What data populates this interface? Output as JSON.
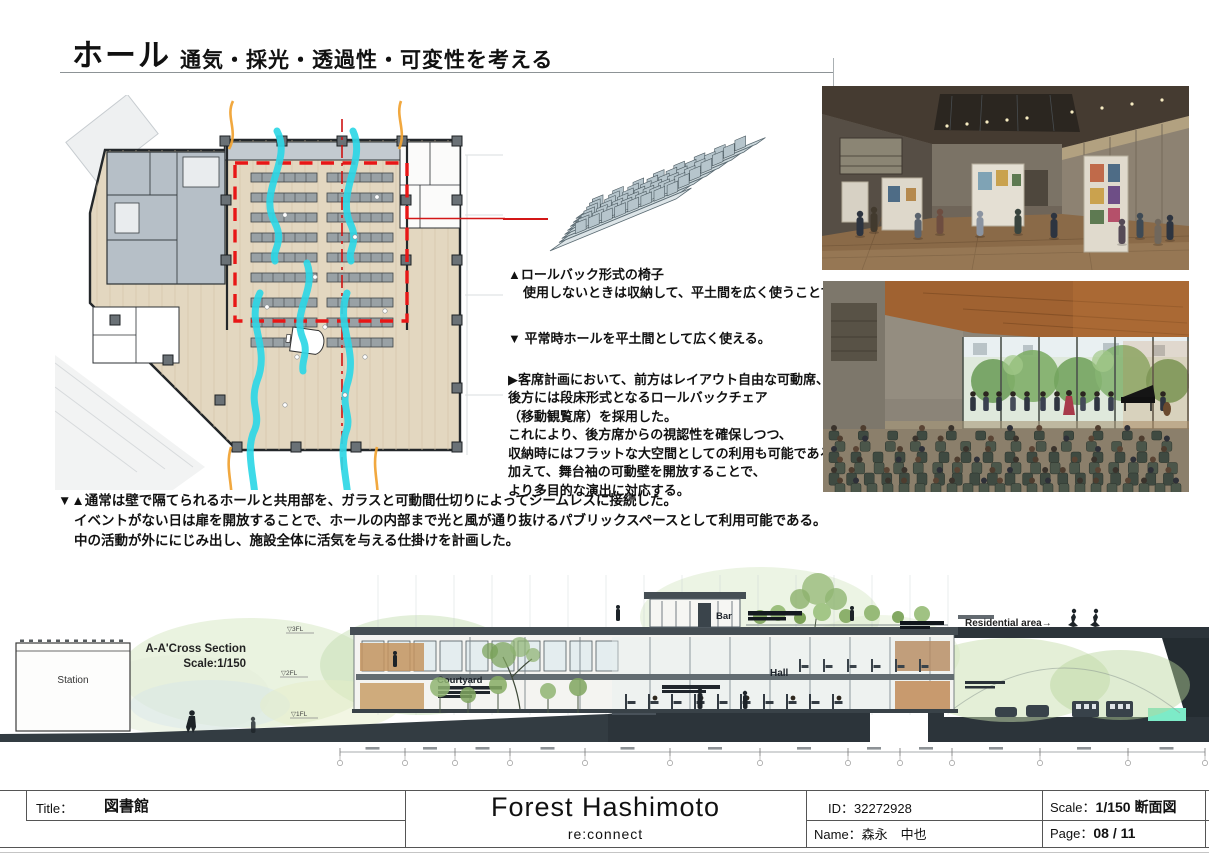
{
  "header": {
    "title": "ホール",
    "subtitle": "通気・採光・透過性・可変性を考える"
  },
  "annotations": {
    "rollback_title": "▲ロールバック形式の椅子",
    "rollback_body": "使用しないときは収納して、平土間を広く使うことできる。",
    "flat_use": "▼ 平常時ホールを平土間として広く使える。",
    "seating_lines": [
      "▶客席計画において、前方はレイアウト自由な可動席、",
      "後方には段床形式となるロールバックチェア",
      "（移動観覧席）を採用した。",
      "これにより、後方席からの視認性を確保しつつ、",
      "収納時にはフラットな大空間としての利用も可能である。",
      "加えて、舞台袖の可動壁を開放することで、",
      "より多目的な演出に対応する。"
    ],
    "seamless_lines": [
      "▼▲通常は壁で隔てられるホールと共用部を、ガラスと可動間仕切りによってシームレスに接続した。",
      "イベントがない日は扉を開放することで、ホールの内部まで光と風が通り抜けるパブリックスペースとして利用可能である。",
      "中の活動が外ににじみ出し、施設全体に活気を与える仕掛けを計画した。"
    ]
  },
  "section": {
    "label": "A-A'Cross Section",
    "scale": "Scale:1/150",
    "station": "Station",
    "bar": "Bar",
    "hall": "Hall",
    "courtyard": "Courtyard",
    "residential_area": "Residential area→",
    "levels": [
      "▽3FL",
      "▽2FL",
      "▽1FL"
    ]
  },
  "titleblock": {
    "title_label": "Title：",
    "title_value": "図書館",
    "project_name": "Forest Hashimoto",
    "project_subtitle": "re:connect",
    "id": "ID：32272928",
    "name": "Name：森永　中也",
    "scale_label": "Scale：",
    "scale_value": "1/150 断面図",
    "page_label": "Page：",
    "page_value": "08 / 11"
  },
  "colors": {
    "airflow_cyan": "#2ed7e6",
    "thermal_orange": "#f0a335",
    "highlight_red": "#e81616",
    "ground_dark": "#333c42",
    "accent_teal": "#7debc8"
  }
}
